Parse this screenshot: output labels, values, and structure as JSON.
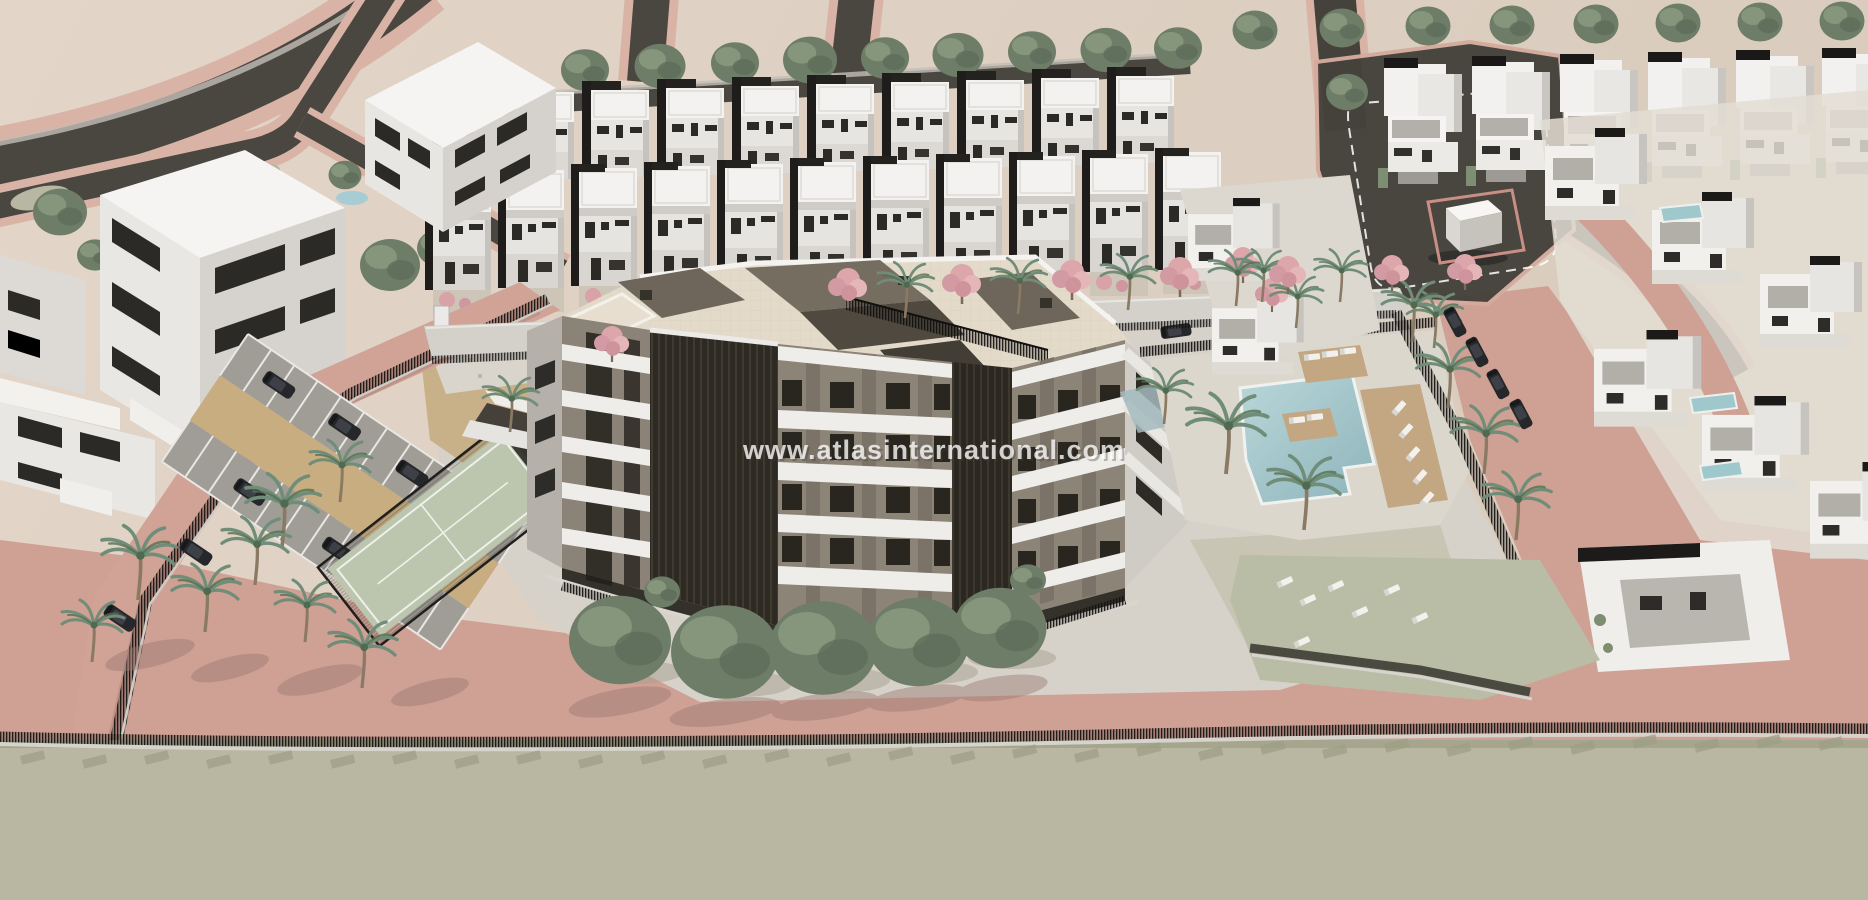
{
  "meta": {
    "type": "3d-architectural-aerial-render",
    "subject": "Aerial CGI masterplan of a residential complex: central apartment building with cream roof terraces, two rows of white townhouses, villa rows, communal swimming pool with sun loungers, padel court, playground and parking lot, surrounded by pink paved roads and a perimeter fence"
  },
  "watermark": {
    "text": "www.atlasinternational.com",
    "color": "#ffffff",
    "opacity": 0.78
  },
  "colors": {
    "sand_ground": "#ded0c2",
    "asphalt_road": "#4a4640",
    "pink_paving": "#cfa094",
    "pink_curb": "#d9b4a6",
    "olive_lot": "#b9b7a1",
    "building_white": "#f2f1ee",
    "building_shade": "#d5d2ce",
    "window_dark": "#2b2a27",
    "roof_cream": "#e3dac9",
    "penthouse_taupe": "#6e665a",
    "facade_recess": "#2d2923",
    "pool_teal": "#9fc4c9",
    "deck_tan": "#c2a782",
    "court_green": "#bcc5ae",
    "grass": "#b7bba3",
    "tree_green": "#6e7d68",
    "palm_green": "#6f8d78",
    "pink_tree": "#dda6ab",
    "car_dark": "#26272a",
    "car_silver": "#b7babf"
  },
  "scene": {
    "areas": [
      "curved-roads-top-left",
      "white-apartment-blocks-top-left",
      "townhouse-back-row",
      "townhouse-front-row",
      "roundabout-plaza-with-cube",
      "villa-row-top-right",
      "villas-east",
      "main-apartment-building",
      "communal-pool",
      "parking-lot",
      "padel-court",
      "playground",
      "garage-ramp",
      "south-lawn-with-loungers",
      "perimeter-fence",
      "pink-road",
      "olive-vacant-lot"
    ]
  }
}
